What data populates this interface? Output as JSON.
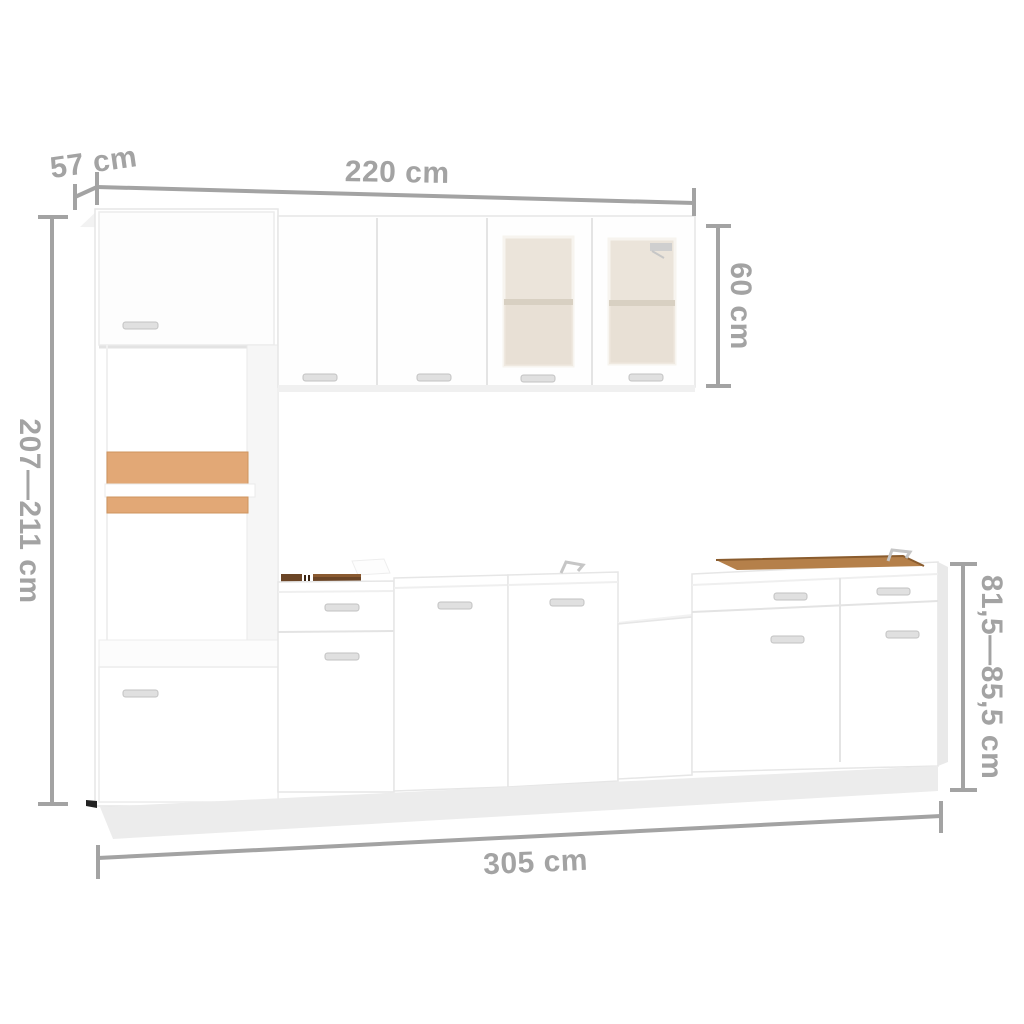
{
  "image": {
    "type": "product-dimension-diagram",
    "subject": "white kitchen cabinet furniture set",
    "background_color": "#ffffff"
  },
  "dimensions": {
    "annotation_color": "#a3a3a3",
    "depth_label": "57 cm",
    "upper_width_label": "220 cm",
    "wall_cabinet_height_label": "60 cm",
    "total_height_label": "207—211 cm",
    "base_height_label": "81,5—85,5 cm",
    "total_width_label": "305 cm"
  },
  "colors": {
    "cabinet_white": "#ffffff",
    "cabinet_edge": "#e6e6e6",
    "cabinet_shade": "#f2f2f2",
    "interior_shade": "#f6f6f6",
    "wood_light": "#e2a876",
    "wood_dark": "#6b4526",
    "wood_rim": "#b5804a",
    "glass_fill": "#ebe4da",
    "glass_shelf": "#d8d0c2",
    "handle_fill": "#e0e0e0",
    "handle_edge": "#c2c2c2",
    "plinth_fill": "#ececec",
    "foot_dark": "#222222"
  }
}
